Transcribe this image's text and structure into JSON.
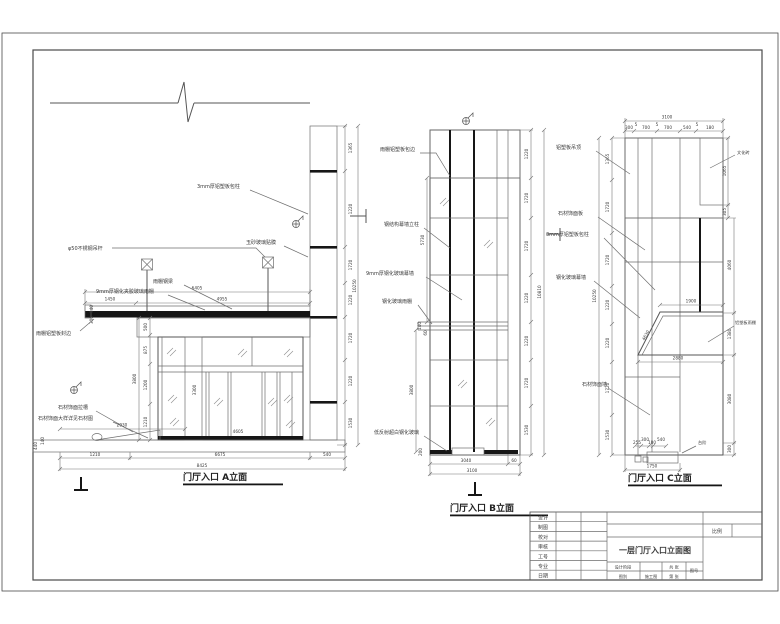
{
  "drawing": {
    "bg": "#ffffff",
    "line_color": "#6e6e6e",
    "accent_dark": "#161616"
  },
  "elevA": {
    "title": "门厅入口 A立面",
    "labels": {
      "hanger": "φ50不锈钢吊杆",
      "column_clad": "3mm厚铝塑板包柱",
      "film": "玉砂玻璃贴膜",
      "beam": "雨棚钢梁",
      "canopy_glass": "9mm厚钢化夹胶玻璃雨棚",
      "canopy_edge": "雨棚铝塑板封边",
      "stone_groove": "石材饰面拉槽",
      "stone_detail": "石材饰面大样详见石材图"
    },
    "dims": {
      "top_total": "6405",
      "top_seg_1": "1450",
      "top_seg_2": "4955",
      "canopy_t1": "140",
      "canopy_t2": "300",
      "store_1": "500",
      "store_2": "875",
      "store_3": "1200",
      "store_4": "1210",
      "store_total": "3800",
      "mullion": "3300",
      "door_w": "4605",
      "ramp": "2930",
      "plinth_1": "440",
      "plinth_2": "140",
      "bottom_1": "1210",
      "bottom_2": "6675",
      "bottom_3": "540",
      "bottom_total": "8425",
      "col_1": "1365",
      "col_2": "1220",
      "col_3": "1720",
      "col_4": "1220",
      "col_5": "1720",
      "col_6": "1220",
      "col_7": "1530",
      "col_total": "10250"
    }
  },
  "elevB": {
    "title": "门厅入口 B立面",
    "labels": {
      "top_clad": "雨棚铝塑板包边",
      "mullion": "钢结构幕墙立柱",
      "curtain": "9mm厚钢化玻璃幕墙",
      "canopy": "钢化玻璃雨棚",
      "door": "低反射超白钢化玻璃"
    },
    "dims": {
      "upper": "5730",
      "lower": "3800",
      "canopy_1": "140",
      "canopy_2": "60",
      "base": "200",
      "bottom_1": "3040",
      "bottom_2": "60",
      "bottom_total": "3100",
      "right_1": "1220",
      "right_2": "1720",
      "right_3": "1720",
      "right_4": "1220",
      "right_5": "1220",
      "right_6": "1720",
      "right_7": "1530",
      "right_total": "10810"
    }
  },
  "elevC": {
    "title": "门厅入口 C立面",
    "labels": {
      "ceiling": "铝塑板吊顶",
      "stone_panel": "石材饰面板",
      "column_clad": "3mm厚铝塑板包柱",
      "glass": "钢化玻璃幕墙",
      "stone_wall": "石材饰面墙",
      "brick": "文化砖",
      "canopy": "铝塑板雨棚",
      "step": "台阶"
    },
    "dims": {
      "top_total": "3100",
      "seg_1": "300",
      "seg_2": "5",
      "seg_3": "700",
      "seg_4": "5",
      "seg_5": "700",
      "seg_6": "540",
      "seg_7": "5",
      "seg_8": "180",
      "brick_h": "1065",
      "brick_b": "305",
      "mid_r": "4060",
      "canopy_w": "1900",
      "canopy_h": "1380",
      "canopy_slope": "4630",
      "below_canopy": "2880",
      "lower_r": "3080",
      "base_r": "300",
      "step_1": "255",
      "step_2": "300",
      "step_3": "180",
      "step_4": "540",
      "bottom_total": "1750",
      "left_1": "1365",
      "left_2": "1720",
      "left_3": "1720",
      "left_4": "1220",
      "left_5": "1220",
      "left_6": "1720",
      "left_7": "1530",
      "left_total": "10250"
    }
  },
  "titleblock": {
    "row_1": "设计",
    "row_2": "制图",
    "row_3": "校对",
    "row_4": "审核",
    "row_5": "工号",
    "row_6": "专业",
    "row_7": "日期",
    "title": "一层门厅入口立面图",
    "stage_label": "设计阶段",
    "stage_value": "施工图",
    "type_label": "图别",
    "sheets_total": "共  张",
    "sheet_no": "第  张",
    "fig_label": "图号",
    "scale_label": "比例"
  }
}
